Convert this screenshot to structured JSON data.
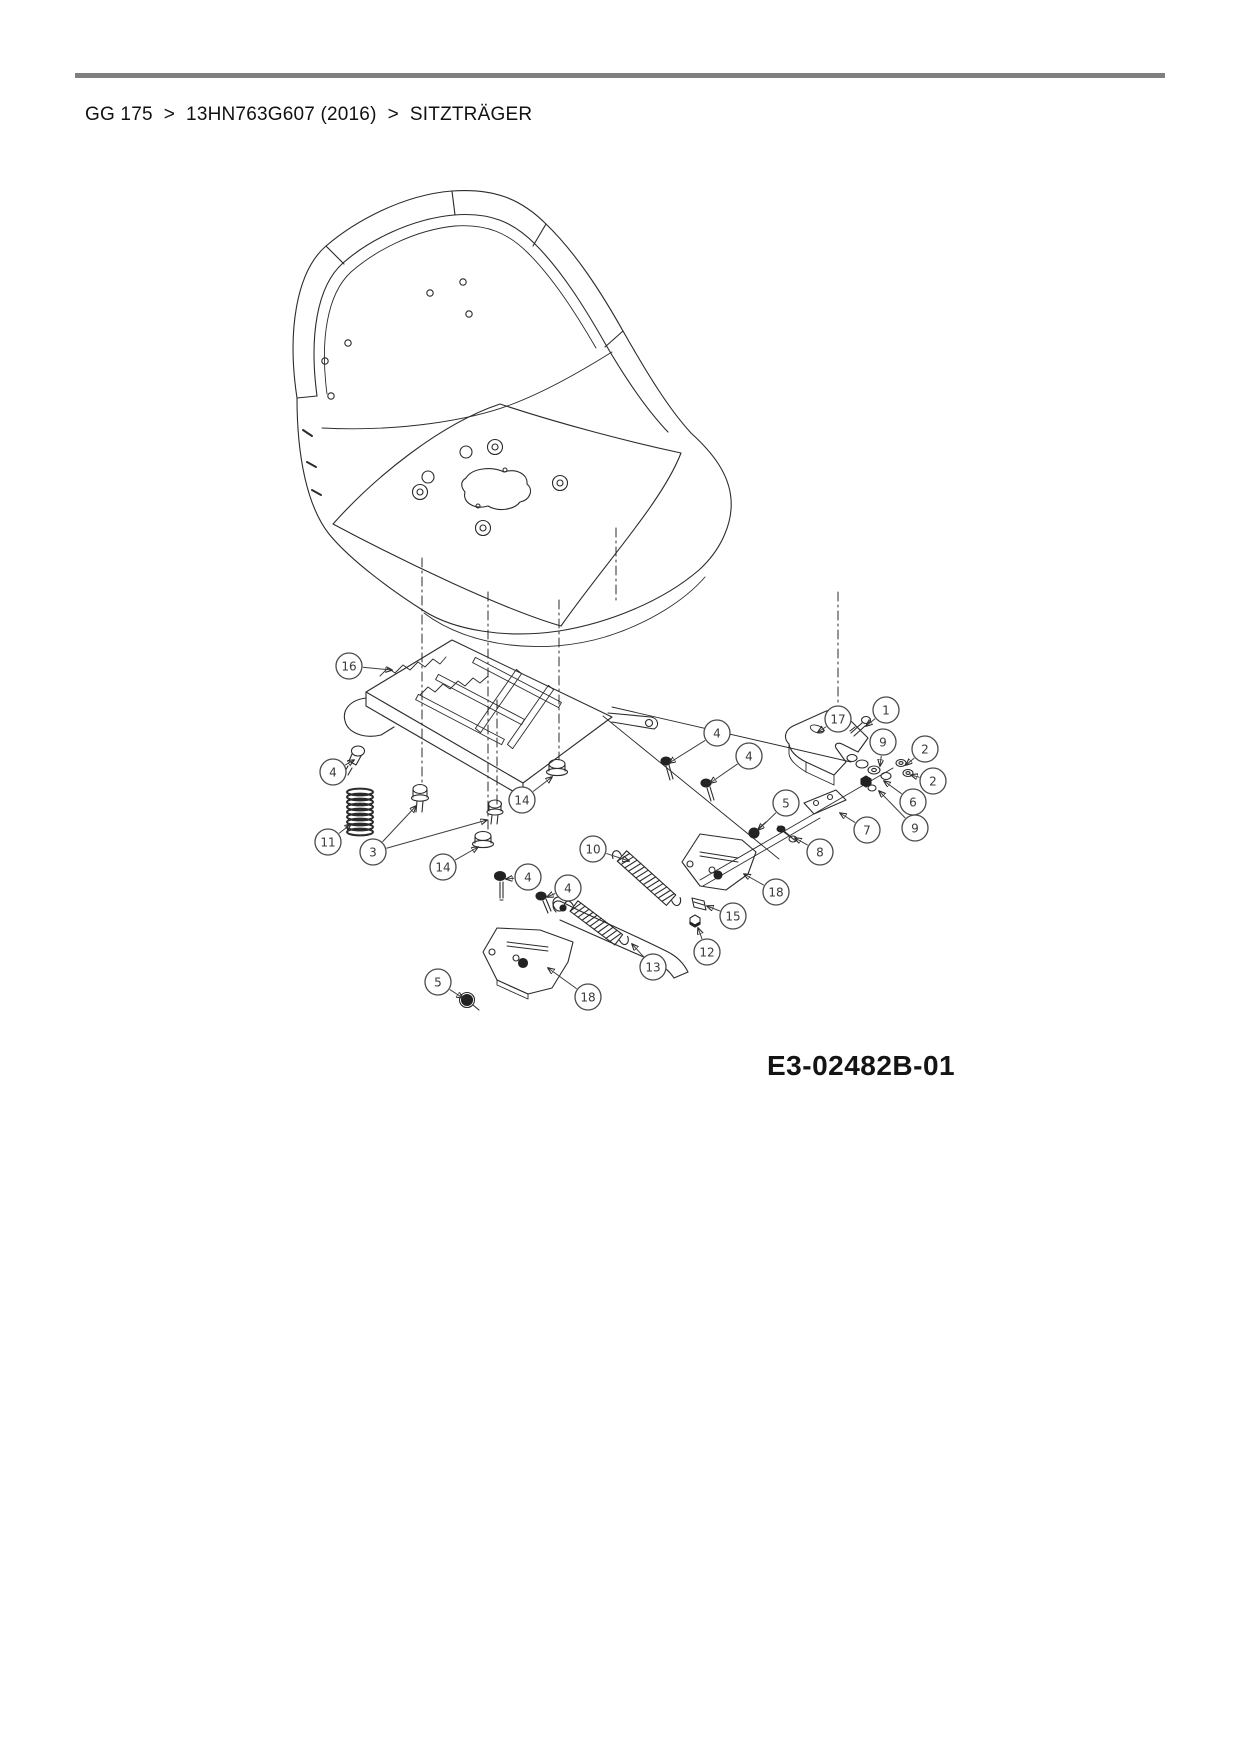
{
  "breadcrumb": {
    "separator": ">",
    "segments": [
      "GG 175",
      "13HN763G607 (2016)",
      "SITZTRÄGER"
    ]
  },
  "diagram": {
    "drawing_number": "E3-02482B-01",
    "subject": "Sitzträger (seat bracket) exploded parts view",
    "colors": {
      "line": "#2b2b2b",
      "rule": "#7f7f7f",
      "background": "#ffffff"
    },
    "callouts": [
      {
        "label": "16",
        "x": 349,
        "y": 666,
        "targets": [
          [
            392,
            670
          ]
        ]
      },
      {
        "label": "4",
        "x": 333,
        "y": 772,
        "targets": [
          [
            354,
            760
          ]
        ]
      },
      {
        "label": "11",
        "x": 328,
        "y": 842,
        "targets": [
          [
            351,
            824
          ]
        ]
      },
      {
        "label": "3",
        "x": 373,
        "y": 852,
        "targets": [
          [
            416,
            806
          ],
          [
            487,
            820
          ]
        ]
      },
      {
        "label": "14",
        "x": 443,
        "y": 867,
        "targets": [
          [
            478,
            847
          ]
        ]
      },
      {
        "label": "14",
        "x": 522,
        "y": 800,
        "targets": [
          [
            552,
            777
          ]
        ]
      },
      {
        "label": "10",
        "x": 593,
        "y": 849,
        "targets": [
          [
            629,
            861
          ]
        ]
      },
      {
        "label": "4",
        "x": 528,
        "y": 877,
        "targets": [
          [
            506,
            879
          ]
        ]
      },
      {
        "label": "4",
        "x": 568,
        "y": 888,
        "targets": [
          [
            547,
            897
          ]
        ]
      },
      {
        "label": "5",
        "x": 438,
        "y": 982,
        "targets": [
          [
            463,
            998
          ]
        ]
      },
      {
        "label": "18",
        "x": 588,
        "y": 997,
        "targets": [
          [
            548,
            968
          ]
        ]
      },
      {
        "label": "13",
        "x": 653,
        "y": 967,
        "targets": [
          [
            632,
            944
          ]
        ]
      },
      {
        "label": "12",
        "x": 707,
        "y": 952,
        "targets": [
          [
            698,
            928
          ]
        ]
      },
      {
        "label": "15",
        "x": 733,
        "y": 916,
        "targets": [
          [
            707,
            906
          ]
        ]
      },
      {
        "label": "18",
        "x": 776,
        "y": 892,
        "targets": [
          [
            744,
            874
          ]
        ]
      },
      {
        "label": "8",
        "x": 820,
        "y": 852,
        "targets": [
          [
            795,
            838
          ]
        ]
      },
      {
        "label": "7",
        "x": 867,
        "y": 830,
        "targets": [
          [
            840,
            813
          ]
        ]
      },
      {
        "label": "9",
        "x": 915,
        "y": 828,
        "targets": [
          [
            879,
            791
          ]
        ]
      },
      {
        "label": "6",
        "x": 913,
        "y": 802,
        "targets": [
          [
            884,
            781
          ]
        ]
      },
      {
        "label": "2",
        "x": 933,
        "y": 781,
        "targets": [
          [
            911,
            775
          ]
        ]
      },
      {
        "label": "2",
        "x": 925,
        "y": 749,
        "targets": [
          [
            906,
            765
          ]
        ]
      },
      {
        "label": "9",
        "x": 883,
        "y": 742,
        "targets": [
          [
            880,
            766
          ]
        ]
      },
      {
        "label": "1",
        "x": 886,
        "y": 710,
        "targets": [
          [
            866,
            726
          ]
        ]
      },
      {
        "label": "17",
        "x": 838,
        "y": 719,
        "targets": [
          [
            818,
            732
          ]
        ]
      },
      {
        "label": "4",
        "x": 717,
        "y": 733,
        "targets": [
          [
            669,
            763
          ]
        ]
      },
      {
        "label": "4",
        "x": 749,
        "y": 756,
        "targets": [
          [
            710,
            783
          ]
        ]
      },
      {
        "label": "5",
        "x": 786,
        "y": 803,
        "targets": [
          [
            758,
            830
          ]
        ]
      }
    ]
  }
}
